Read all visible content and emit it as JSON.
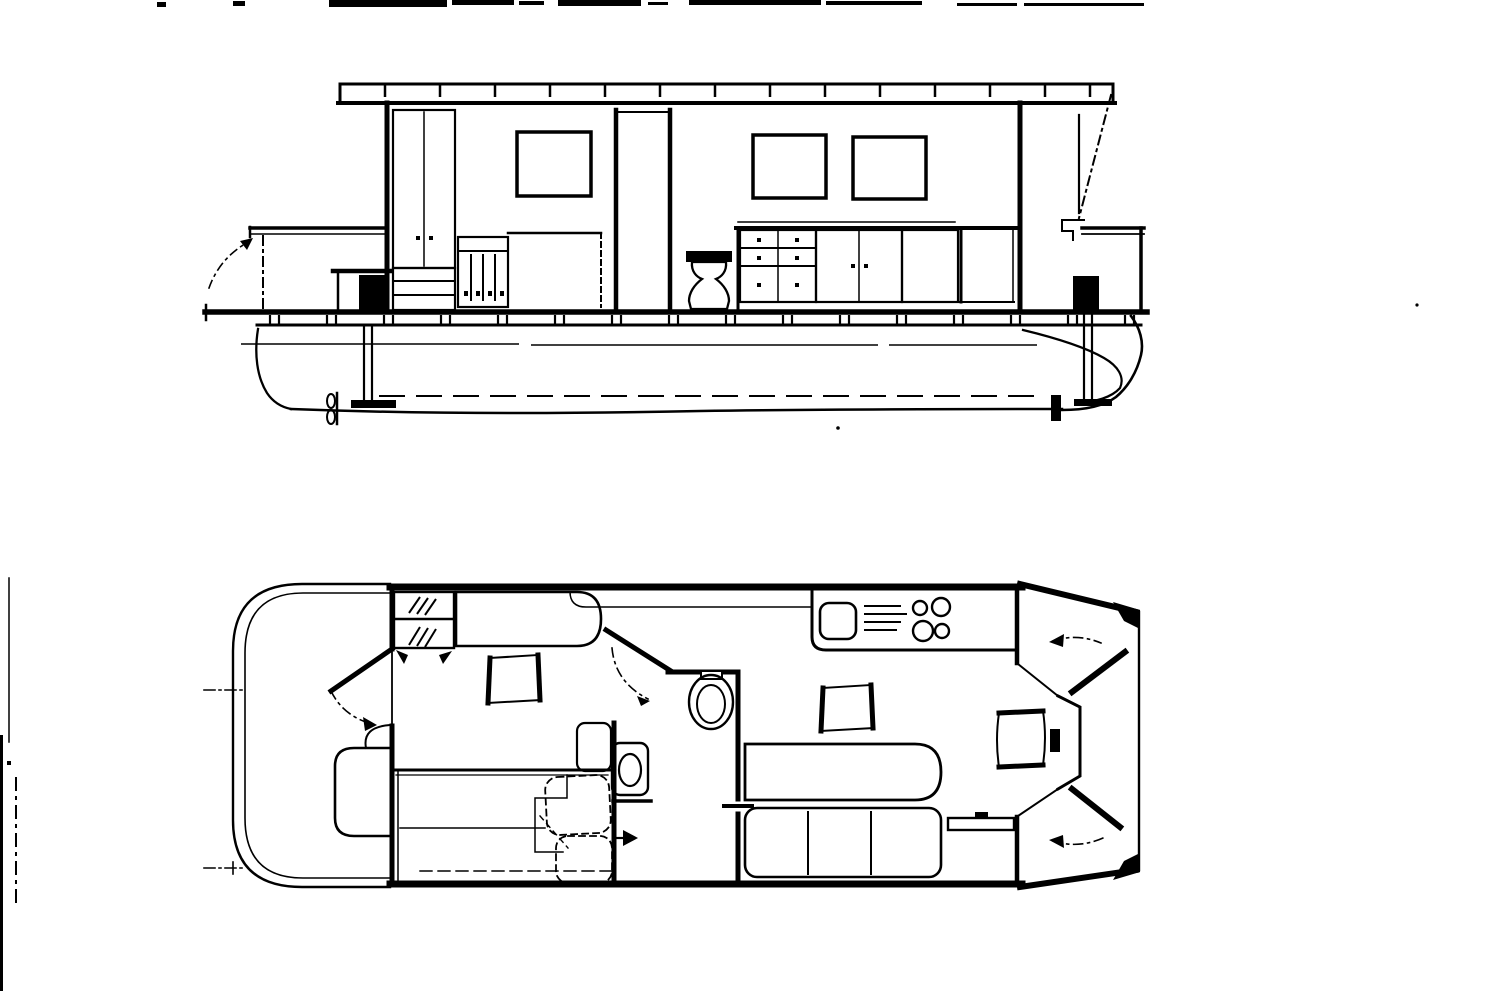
{
  "page": {
    "background_color": "#ffffff",
    "line_color": "#000000",
    "text_content": "none — drawing contains no rendered text"
  },
  "figure": {
    "kind": "black-and-white technical line drawing",
    "subject": "pontoon houseboat general arrangement",
    "views": {
      "elevation": {
        "name": "side-elevation",
        "aria": "Side elevation view of houseboat with cabin, windows, galley, toilet, pontoon hull and propeller struts"
      },
      "plan": {
        "name": "deck-plan",
        "aria": "Deck plan view of houseboat with stern deck, cabin, berth, bathroom, galley, saloon seating, helm and bow deck"
      }
    },
    "elements": {
      "elevation": [
        "roof-slab",
        "cabin-window x3",
        "wardrobe",
        "drawer-chest",
        "shelf-locker",
        "berth",
        "bathroom-partition",
        "toilet",
        "galley-counter",
        "drawer-unit",
        "door-cabinets",
        "tall-locker",
        "bow-windshield",
        "bow-railing",
        "motor",
        "propeller-strut x2",
        "stern-canopy",
        "stern-table",
        "deck-beams",
        "pontoon-hull",
        "waterline"
      ],
      "plan": [
        "hull-outline",
        "stern-deck",
        "cabin-front-wall",
        "hatched-locker",
        "sofa",
        "armchair x2",
        "bathroom",
        "toilet",
        "washbasin",
        "double-berth",
        "pillows",
        "galley-counter",
        "sink",
        "stove-burners",
        "saloon-berth",
        "settee-3-cushion",
        "side-shelf",
        "helm-console",
        "helm-chair",
        "bow-doors",
        "door-swing-arcs",
        "bow-cleats"
      ]
    }
  }
}
